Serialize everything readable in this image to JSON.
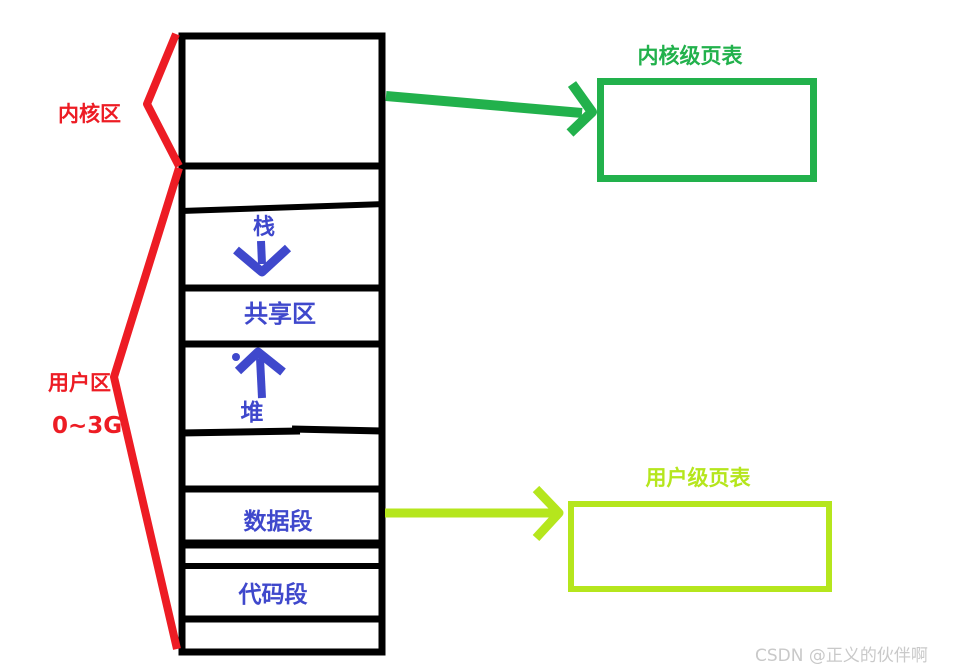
{
  "memory_map": {
    "kernel_label": "内核区",
    "user_label": "用户区",
    "user_range": "0~3G",
    "segments": {
      "stack": "栈",
      "shared": "共享区",
      "heap": "堆",
      "data": "数据段",
      "code": "代码段"
    }
  },
  "page_tables": {
    "kernel_label": "内核级页表",
    "user_label": "用户级页表"
  },
  "watermark": "CSDN @正义的伙伴啊",
  "colors": {
    "red": "#ed1c24",
    "blue": "#3f48cc",
    "green": "#22b14c",
    "lime": "#b5e61d",
    "black": "#000000",
    "watermark_gray": "#c9c9c9"
  }
}
